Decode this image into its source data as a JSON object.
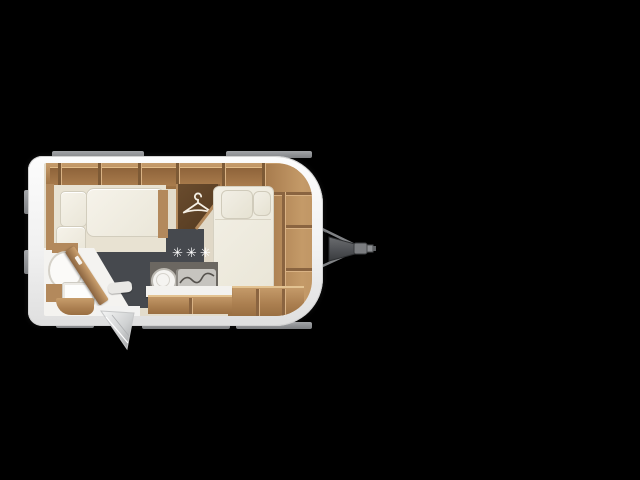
{
  "scene": {
    "description": "Top-down caravan floor plan on black background",
    "background_color": "#000000"
  },
  "floorplan": {
    "rating_stars": "✳✳✳",
    "palette": {
      "shell_white": "#f4f4f4",
      "wood": "#b3895c",
      "wood_dark": "#8a6440",
      "wardrobe_brown": "#5c3f24",
      "floor_dark": "#46494e",
      "floor_cream": "#e0d8c7",
      "cushion_ivory": "#f0ede2",
      "kitchen_gray": "#6b6761",
      "trim_gray": "#8e9094",
      "hitch_gray": "#55575a",
      "star_white": "#ffffff"
    },
    "features": [
      {
        "id": "overhead-lockers",
        "label": "Overhead lockers along rear wall"
      },
      {
        "id": "dinette-bed",
        "label": "Side dinette / single bed with cushions"
      },
      {
        "id": "wardrobe",
        "label": "Wardrobe with clothes-hanger symbol",
        "icon": "hanger-icon"
      },
      {
        "id": "french-bed",
        "label": "French double bed with two pillows"
      },
      {
        "id": "front-shelves",
        "label": "Wrap-around shelving at curved front"
      },
      {
        "id": "kitchen",
        "label": "Kitchen block with round sink and hob",
        "icons": [
          "sink-icon",
          "hob-icon"
        ]
      },
      {
        "id": "bathroom",
        "label": "Washroom with toilet, washbasin and angled partition",
        "icons": [
          "toilet-icon",
          "washbasin-icon"
        ]
      },
      {
        "id": "entrance-door",
        "label": "Entrance door shown open",
        "icon": "door-open-icon"
      },
      {
        "id": "tow-hitch",
        "label": "A-frame drawbar with coupling head",
        "icon": "tow-hitch-icon"
      },
      {
        "id": "comfort-rating",
        "label": "Three-star marking on floor",
        "icon": "star-rating"
      }
    ]
  }
}
